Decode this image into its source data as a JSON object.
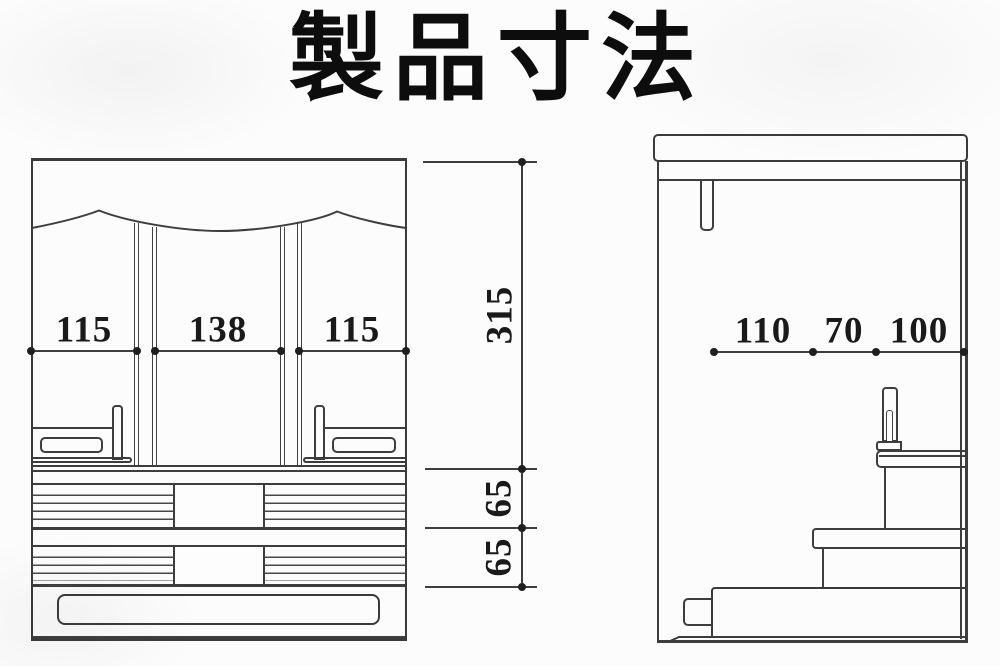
{
  "title": "製品寸法",
  "dims": {
    "front_widths": [
      "115",
      "138",
      "115"
    ],
    "front_heights": [
      "315",
      "65",
      "65"
    ],
    "side_depths": [
      "110",
      "70",
      "100"
    ]
  },
  "colors": {
    "line": "#3e3e3e",
    "paper": "#fcfcfc",
    "ink": "#1a1a1a"
  }
}
